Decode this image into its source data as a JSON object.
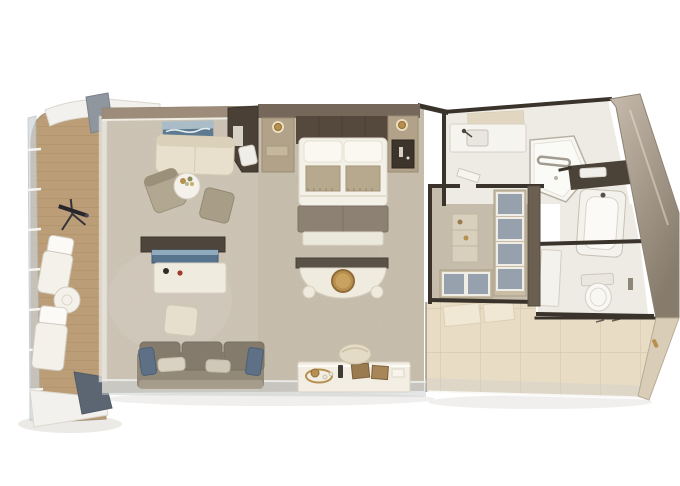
{
  "scene": {
    "title": "Top-down 3D rendered floor plan of a suite with balcony, living room, bedroom, walk-in closet, bathroom, water closet and entry hall",
    "view": "top-down axonometric render",
    "canvas": {
      "width": 680,
      "height": 486
    }
  },
  "palette": {
    "background": "#ffffff",
    "shadow": "#dcd8d1",
    "deck": "#bb9d77",
    "deck_plank": "#9f8157",
    "rail_glass": "#ccd3d6",
    "canopy": "#f2f1ed",
    "divider_light": "#8f969e",
    "divider_dark": "#5c6672",
    "carpet": "#cbc1b1",
    "bath_floor": "#eeebe4",
    "tile_floor": "#e8dcc5",
    "tile_grout": "#d5c5a8",
    "glass": "#c7cdd0",
    "wall_dark": "#3a332b",
    "wall_taupe": "#9c8c79",
    "wall_mirror_light": "#c6bbac",
    "wall_mirror_dark": "#877b6c",
    "wall_band": "#6a5f50",
    "headboard_wall": "#75685a",
    "headboard": "#55493d",
    "nightstand": "#b1a289",
    "lamp_glow": "#f3e3c2",
    "gold": "#b78f4e",
    "bed_white": "#f3f0e7",
    "pillow_white": "#faf8f1",
    "runner": "#b7a98d",
    "bench": "#8d8173",
    "bed_base": "#ebe8dc",
    "vanity_back": "#5a5147",
    "desk_white": "#efebdf",
    "cream_sofa": "#e8e0cc",
    "armchair": "#b2a791",
    "ottoman": "#a89d87",
    "ottoman_light": "#e6dfcd",
    "table_white": "#f3f1ea",
    "sofa": "#938979",
    "sofa_back": "#857b6c",
    "pillow_blue": "#5e7086",
    "pillow_cream": "#d9d2c2",
    "tv_frame": "#4e463c",
    "tv_screen": "#57748f",
    "tv_sky": "#8fa9bd",
    "art_sea": "#5d7a91",
    "art_sky": "#a9bcc8",
    "console_white": "#f2eee3",
    "box_brown": "#9a7b50",
    "stool_cream": "#e4dbc6",
    "red_accent": "#a33a2e",
    "partition": "#4a4036",
    "chair_white": "#f0eee8",
    "closet_cabinet": "#c9bda6",
    "cabinet_top": "#96a1ad",
    "shelf_cream": "#d8d0bd",
    "shower_white": "#f7f6f1",
    "tub_white": "#f4f2ec",
    "tub_inner": "#fbfaf7",
    "counter_dark": "#4b4238",
    "toilet_white": "#f8f7f3",
    "door_wall": "#d9cdb8",
    "wc_door": "#f4f2ec"
  },
  "rooms": {
    "balcony": {
      "label": "balcony-veranda",
      "items": [
        "deck",
        "glass-railing",
        "canopy",
        "privacy-divider",
        "telescope",
        "lounge-chair",
        "lounge-chair",
        "round-table"
      ]
    },
    "living_room": {
      "label": "living-room",
      "items": [
        "seascape-artwork",
        "loveseat",
        "armchair",
        "flower-side-table",
        "ottoman",
        "tv-media-desk",
        "tv-screen",
        "footstool",
        "three-seat-sofa",
        "accent-pillows",
        "bar-console",
        "tea-tray",
        "round-stool"
      ]
    },
    "bedroom": {
      "label": "bedroom",
      "items": [
        "king-bed",
        "pillows",
        "bed-runners",
        "foot-bench",
        "nightstand-left",
        "reading-lamp",
        "nightstand-right",
        "minibar-shelf",
        "writing-partition",
        "desk-chair",
        "vanity-table",
        "gold-mirror"
      ]
    },
    "walk_in_closet": {
      "label": "walk-in-closet",
      "items": [
        "wardrobe-cabinets",
        "luggage-bench",
        "open-shelf"
      ]
    },
    "bathroom": {
      "label": "bathroom",
      "items": [
        "vanity-counter",
        "sink",
        "faucet",
        "shower",
        "towel-rail",
        "bathtub",
        "towel-shelf"
      ]
    },
    "water_closet": {
      "label": "water-closet",
      "items": [
        "toilet",
        "door"
      ]
    },
    "entry_hall": {
      "label": "entry-hall",
      "items": [
        "tile-floor",
        "door-mats",
        "suite-door",
        "door-handle"
      ]
    }
  }
}
